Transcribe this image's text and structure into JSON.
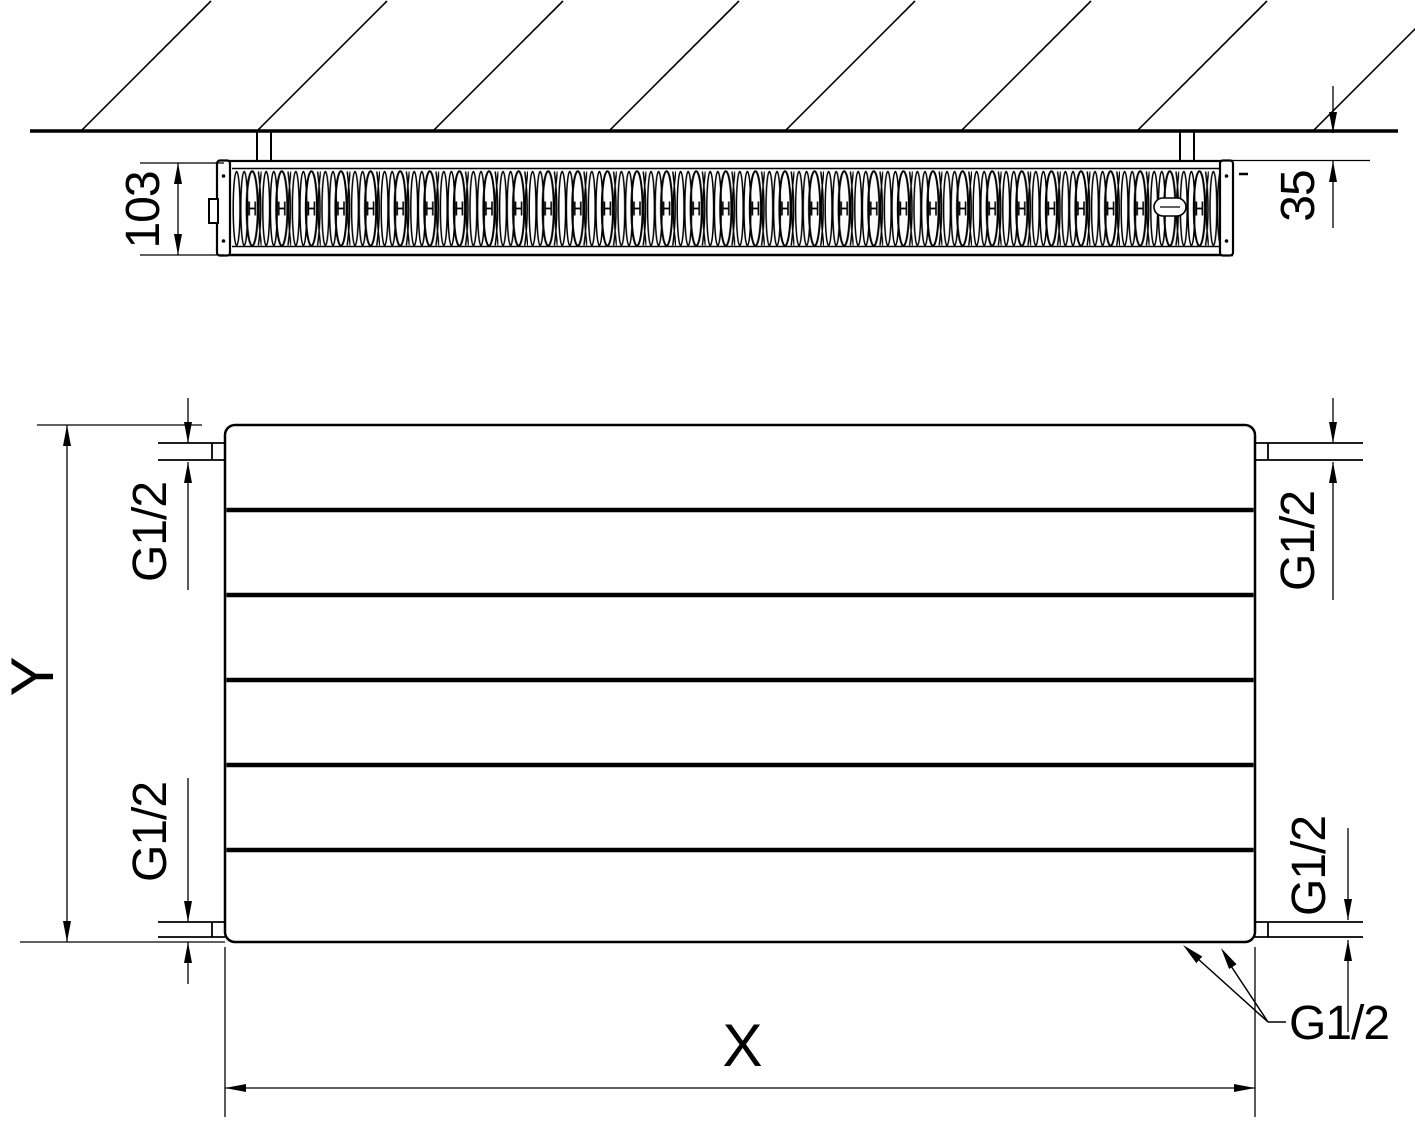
{
  "drawing": {
    "colors": {
      "line": "#000000",
      "background": "#ffffff"
    },
    "top_view": {
      "depth": "103",
      "wall_distance": "35"
    },
    "front_view": {
      "height": "Y",
      "width": "X",
      "thread_top_left": "G1/2",
      "thread_top_right": "G1/2",
      "thread_bottom_left": "G1/2",
      "thread_bottom_right_side": "G1/2",
      "thread_bottom_leader": "G1/2"
    }
  }
}
